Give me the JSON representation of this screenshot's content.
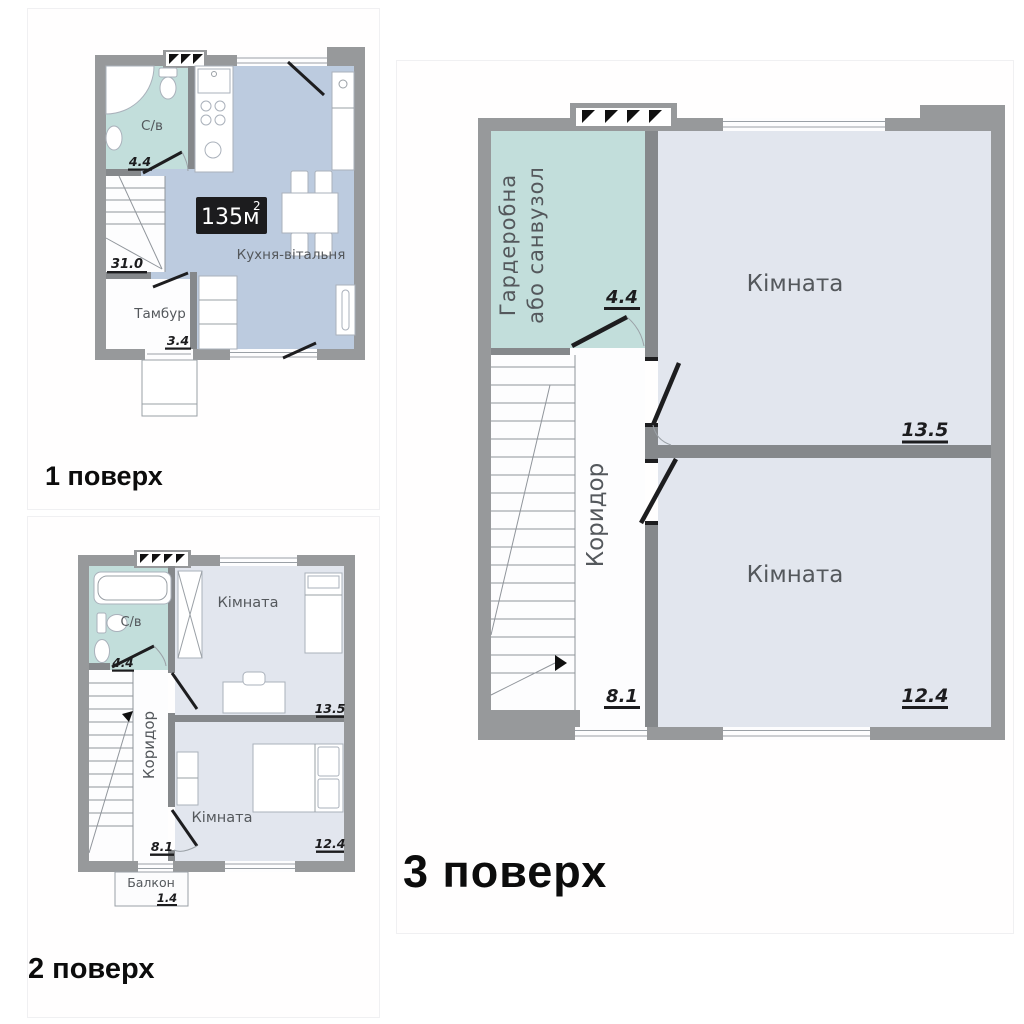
{
  "floors": [
    {
      "label": "1 поверх",
      "badge": {
        "value": "135м",
        "sup": "2"
      },
      "rooms": {
        "bathroom": {
          "name": "С/в",
          "area": "4.4"
        },
        "kitchen": {
          "name": "Кухня-вітальня",
          "area": "31.0"
        },
        "vestibule": {
          "name": "Тамбур",
          "area": "3.4"
        }
      }
    },
    {
      "label": "2 поверх",
      "rooms": {
        "bathroom": {
          "name": "С/в",
          "area": "4.4"
        },
        "room_top": {
          "name": "Кімната",
          "area": "13.5"
        },
        "corridor": {
          "name": "Коридор",
          "area": "8.1"
        },
        "room_bottom": {
          "name": "Кімната",
          "area": "12.4"
        },
        "balcony": {
          "name": "Балкон",
          "area": "1.4"
        }
      }
    },
    {
      "label": "3 поверх",
      "rooms": {
        "wardrobe": {
          "name_line1": "Гардеробна",
          "name_line2": "або санвузол",
          "area": "4.4"
        },
        "room_top": {
          "name": "Кімната",
          "area": "13.5"
        },
        "corridor": {
          "name": "Коридор",
          "area": "8.1"
        },
        "room_bottom": {
          "name": "Кімната",
          "area": "12.4"
        }
      }
    }
  ],
  "colors": {
    "wall": "#97999b",
    "wall_inner": "#85888b",
    "wet": "#c2dedb",
    "kitchen": "#bccbdf",
    "room": "#e2e6ee",
    "badge_bg": "#1c1c1e",
    "number": "#1c1c1e",
    "label": "#54585c"
  }
}
